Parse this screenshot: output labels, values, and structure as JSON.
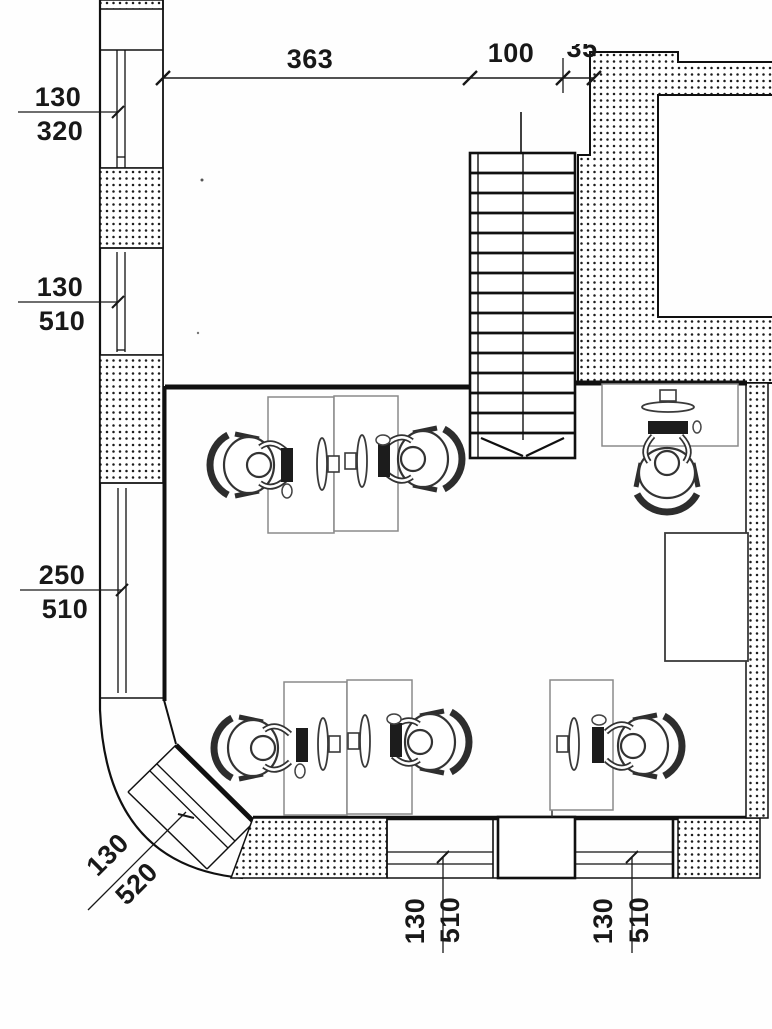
{
  "drawing": {
    "type": "architectural floor plan, scanned office layout with staircase and workstations"
  },
  "dims": {
    "top_width_main": "363",
    "top_width_stair": "100",
    "top_width_wall": "35",
    "left_top": {
      "w": "130",
      "h": "320"
    },
    "left_mid": {
      "w": "130",
      "h": "510"
    },
    "left_low": {
      "w": "250",
      "h": "510"
    },
    "corner": {
      "w": "130",
      "h": "520"
    },
    "bottom_a": {
      "w": "130",
      "h": "510"
    },
    "bottom_b": {
      "w": "130",
      "h": "510"
    }
  }
}
